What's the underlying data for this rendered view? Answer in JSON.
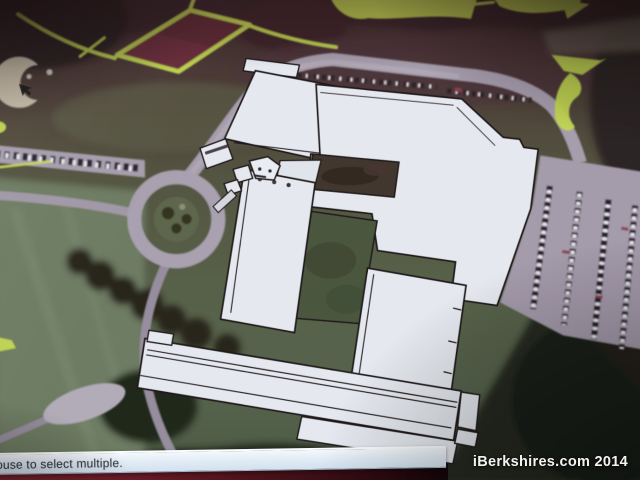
{
  "window": {
    "status_bar": {
      "text": "ouse to select multiple."
    },
    "watermark": {
      "text": "iBerkshires.com 2014"
    }
  },
  "icons": {
    "cursor": "cursor-arrow"
  },
  "colors": {
    "highlight_marker": "#c5dd46",
    "tennis_court": "#702c3a",
    "building_fill": "#e8ecf3",
    "building_outline": "#1c1318",
    "road": "#a89eaf",
    "grass_field": "#6d7c61",
    "courtyard_grass": "#49553b",
    "status_bar_bg": "#e9f1f8",
    "status_bar_text": "#3b4148",
    "watermark_text": "#f4f3f1",
    "photo_bottom_edge": "#5a1620"
  }
}
